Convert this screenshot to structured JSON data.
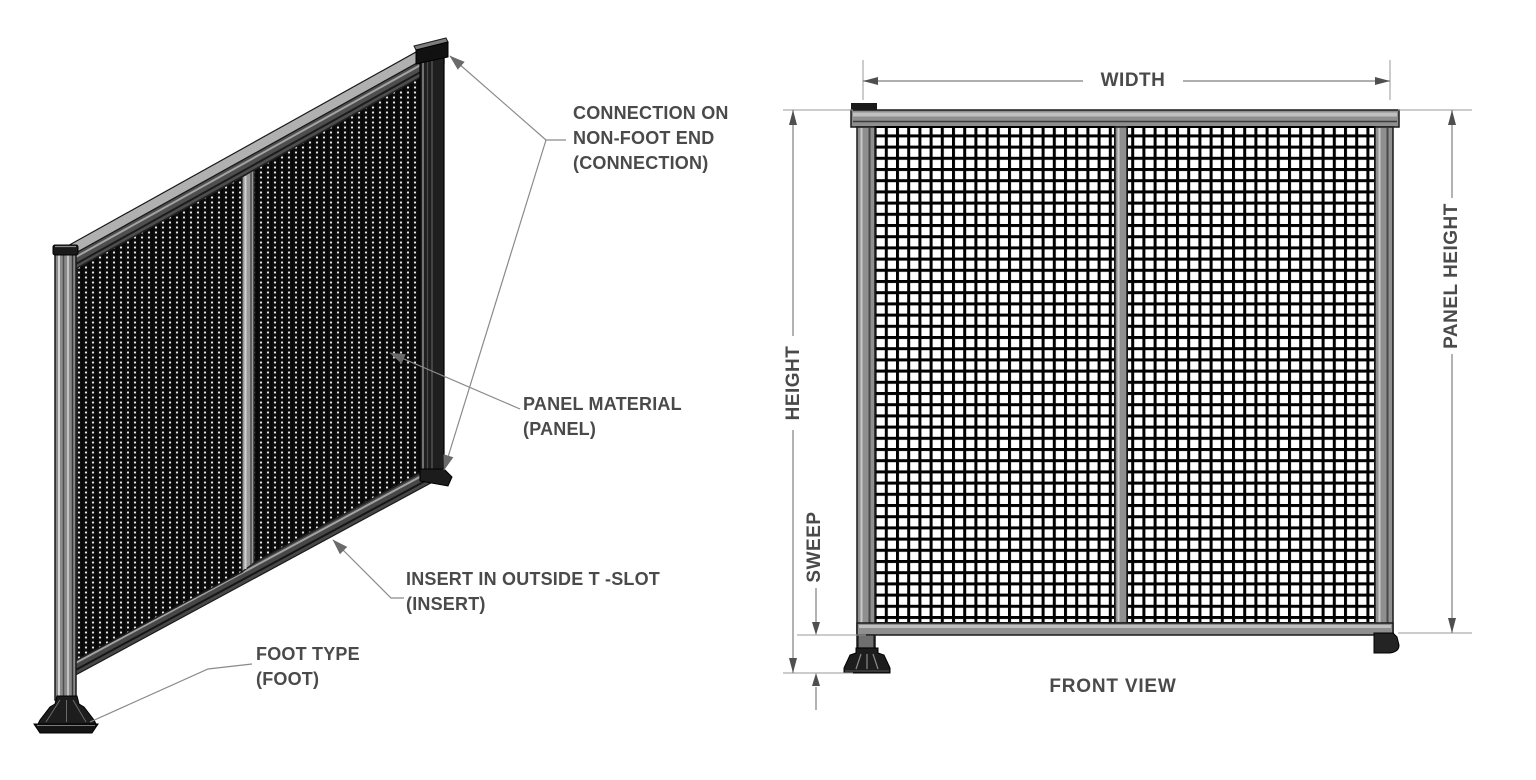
{
  "page": {
    "background": "#ffffff"
  },
  "colors": {
    "label_text": "#4a4a4a",
    "dimension_line": "#7f7f7f",
    "extension_line": "#9a9a9a",
    "arrow_fill": "#4f4f4f",
    "outline": "#1a1a1a",
    "metal_gray": "#8f8f8f",
    "metal_light": "#c2c2c2",
    "metal_dark": "#3c3c3c",
    "mesh_dark": "#0d0d0d",
    "foot_black": "#1d1d1d"
  },
  "isometric_view": {
    "callouts": [
      {
        "id": "connection",
        "lines": [
          "CONNECTION ON",
          "NON-FOOT END",
          "(CONNECTION)"
        ]
      },
      {
        "id": "panel",
        "lines": [
          "PANEL MATERIAL",
          "(PANEL)"
        ]
      },
      {
        "id": "insert",
        "lines": [
          "INSERT IN OUTSIDE T -SLOT",
          "(INSERT)"
        ]
      },
      {
        "id": "foot",
        "lines": [
          "FOOT TYPE",
          "(FOOT)"
        ]
      }
    ]
  },
  "front_view": {
    "caption": "FRONT VIEW",
    "dimensions": {
      "width": "WIDTH",
      "height": "HEIGHT",
      "sweep": "SWEEP",
      "panel_height": "PANEL HEIGHT"
    }
  }
}
